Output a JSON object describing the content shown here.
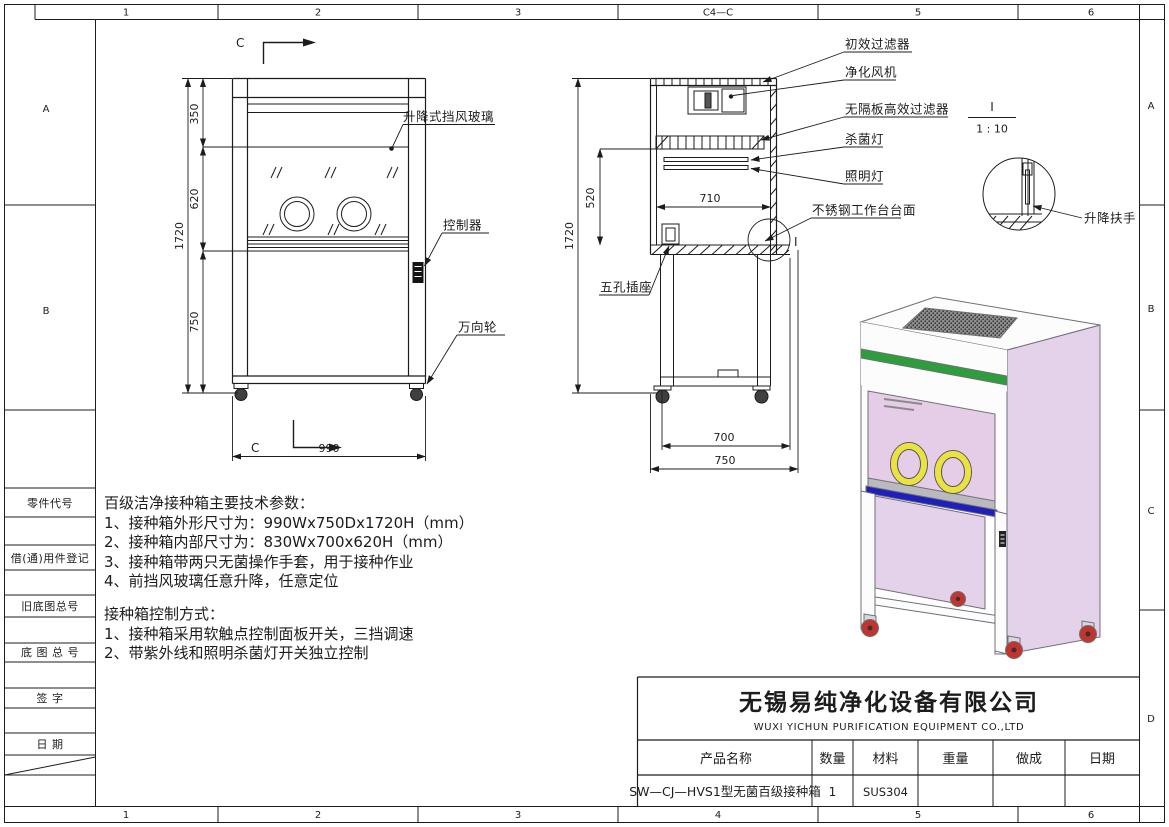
{
  "frame": {
    "top_labels": [
      "1",
      "2",
      "3",
      "C4—C",
      "5",
      "6"
    ],
    "bottom_labels": [
      "1",
      "2",
      "3",
      "4",
      "5",
      "6"
    ],
    "right_labels": [
      "A",
      "B",
      "C",
      "D"
    ],
    "left_labels": [
      "A",
      "B"
    ],
    "sidebar_labels": [
      "零件代号",
      "借(通)用件登记",
      "旧底图总号",
      "底 图 总 号",
      "签  字",
      "日  期"
    ]
  },
  "front_view": {
    "section_letter": "C",
    "dim_350": "350",
    "dim_620": "620",
    "dim_1720": "1720",
    "dim_750": "750",
    "dim_990": "990",
    "label_lift_glass": "升降式挡风玻璃",
    "label_controller": "控制器",
    "label_caster": "万向轮"
  },
  "section_view": {
    "dim_1720": "1720",
    "dim_520": "520",
    "dim_710": "710",
    "dim_700": "700",
    "dim_750": "750",
    "label_pre_filter": "初效过滤器",
    "label_fan": "净化风机",
    "label_hepa": "无隔板高效过滤器",
    "label_uv_lamp": "杀菌灯",
    "label_light": "照明灯",
    "label_worktop": "不锈钢工作台台面",
    "label_socket": "五孔插座",
    "detail_mark": "I"
  },
  "detail_view": {
    "mark": "I",
    "scale": "1 : 10",
    "label_handle": "升降扶手"
  },
  "tech_specs": {
    "title": "百级洁净接种箱主要技术参数：",
    "items": [
      "1、接种箱外形尺寸为：990Wx750Dx1720H（mm）",
      "2、接种箱内部尺寸为：830Wx700x620H（mm）",
      "3、接种箱带两只无菌操作手套，用于接种作业",
      "4、前挡风玻璃任意升降，任意定位"
    ],
    "control_title": "接种箱控制方式：",
    "control_items": [
      "1、接种箱采用软触点控制面板开关，三挡调速",
      "2、带紫外线和照明杀菌灯开关独立控制"
    ]
  },
  "title_block": {
    "company_cn": "无锡易纯净化设备有限公司",
    "company_en": "WUXI YICHUN PURIFICATION EQUIPMENT CO.,LTD",
    "headers": [
      "产品名称",
      "数量",
      "材料",
      "重量",
      "做成",
      "日期"
    ],
    "values": [
      "SW—CJ—HVS1型无菌百级接种箱",
      "1",
      "SUS304",
      "",
      "",
      ""
    ]
  },
  "iso_view": {
    "colors": {
      "panel_pink": "#e4d1ea",
      "interior_pink": "#e6cde7",
      "green_band": "#2e9e3c",
      "blue_band": "#1f1fbb",
      "glove_yellow": "#e9e23f",
      "wheel_red": "#c2342c",
      "surface_gray": "#b9b9be",
      "white_face": "#fcfcfd"
    }
  }
}
